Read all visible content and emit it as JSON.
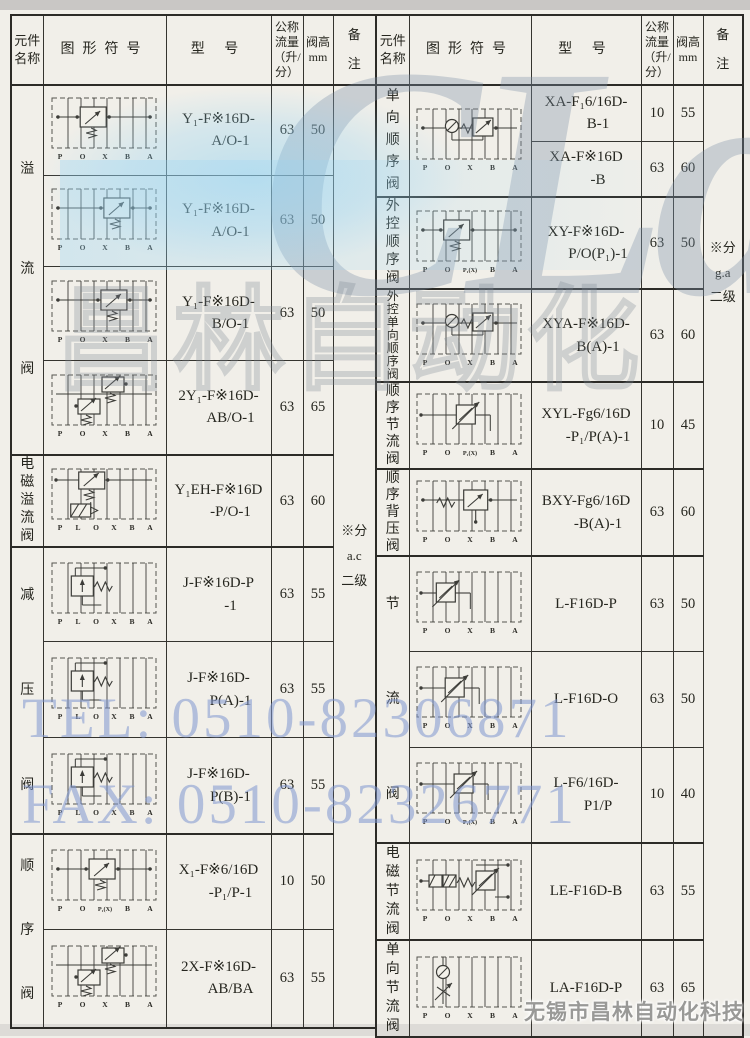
{
  "colors": {
    "paper": "#f1efe9",
    "border": "#35342f",
    "tint_blue": "#8cd0f2",
    "watermark_blue": "#7e96d0"
  },
  "watermarks": {
    "logo_text": "CLair",
    "logo_cn": "昌林自动化",
    "tel": "TEL: 0510-82306871",
    "fax": "FAX: 0510-82326771",
    "company": "无锡市昌林自动化科技"
  },
  "header": {
    "name": "元件名称",
    "symbol": "图形符号",
    "model": "型  号",
    "flow": "公称流量（升/分）",
    "height_line1": "阀高",
    "height_line2": "mm",
    "note_line1": "备",
    "note_line2": "注"
  },
  "left_table": {
    "note_lines": [
      "※分",
      "a.c",
      "二级"
    ],
    "groups": [
      {
        "name": "溢流阀",
        "rows": 4
      },
      {
        "name": "电磁溢流阀",
        "rows": 1
      },
      {
        "name": "减压阀",
        "rows": 3
      },
      {
        "name": "顺序阀",
        "rows": 2
      }
    ],
    "rows": [
      {
        "model": [
          "Y₁-F※16D-",
          "A/O-1"
        ],
        "flow": "63",
        "height": "50",
        "symbol": {
          "type": "relief",
          "vx": 0.3,
          "ports": [
            "P",
            "O",
            "X",
            "B",
            "A"
          ]
        }
      },
      {
        "model": [
          "Y₁-F※16D-",
          "A/O-1"
        ],
        "flow": "63",
        "height": "50",
        "symbol": {
          "type": "relief",
          "vx": 0.62,
          "ports": [
            "P",
            "O",
            "X",
            "B",
            "A"
          ]
        }
      },
      {
        "model": [
          "Y₁-F※16D-",
          "B/O-1"
        ],
        "flow": "63",
        "height": "50",
        "symbol": {
          "type": "relief",
          "vx": 0.58,
          "ports": [
            "P",
            "O",
            "X",
            "B",
            "A"
          ]
        }
      },
      {
        "model": [
          "2Y₁-F※16D-",
          "AB/O-1"
        ],
        "flow": "63",
        "height": "65",
        "symbol": {
          "type": "relief2",
          "vx": 0.5,
          "ports": [
            "P",
            "O",
            "X",
            "B",
            "A"
          ]
        }
      },
      {
        "model": [
          "Y₁EH-F※16D",
          "-P/O-1"
        ],
        "flow": "63",
        "height": "60",
        "symbol": {
          "type": "solenoid-relief",
          "vx": 0.28,
          "ports": [
            "P",
            "L",
            "O",
            "X",
            "B",
            "A"
          ]
        }
      },
      {
        "model": [
          "J-F※16D-P",
          "-1"
        ],
        "flow": "63",
        "height": "55",
        "symbol": {
          "type": "reduce",
          "vx": 0.18,
          "ports": [
            "P",
            "L",
            "O",
            "X",
            "B",
            "A"
          ]
        }
      },
      {
        "model": [
          "J-F※16D-",
          "P(A)-1"
        ],
        "flow": "63",
        "height": "55",
        "symbol": {
          "type": "reduce",
          "vx": 0.18,
          "ports": [
            "P",
            "L",
            "O",
            "X",
            "B",
            "A"
          ]
        }
      },
      {
        "model": [
          "J-F※16D-",
          "P(B)-1"
        ],
        "flow": "63",
        "height": "55",
        "symbol": {
          "type": "reduce",
          "vx": 0.18,
          "ports": [
            "P",
            "L",
            "O",
            "X",
            "B",
            "A"
          ]
        }
      },
      {
        "model": [
          "X₁-F※6/16D",
          "-P₁/P-1"
        ],
        "flow": "10",
        "height": "50",
        "symbol": {
          "type": "relief",
          "vx": 0.42,
          "ports": [
            "P",
            "O",
            "P₁(X)",
            "B",
            "A"
          ]
        }
      },
      {
        "model": [
          "2X-F※16D-",
          "AB/BA"
        ],
        "flow": "63",
        "height": "55",
        "symbol": {
          "type": "relief2",
          "vx": 0.58,
          "ports": [
            "P",
            "O",
            "X",
            "B",
            "A"
          ]
        }
      }
    ]
  },
  "right_table": {
    "note_lines": [
      "※分",
      "g.a",
      "二级"
    ],
    "groups": [
      {
        "name": "单向顺序阀",
        "rows": 2
      },
      {
        "name": "外控顺序阀",
        "rows": 1
      },
      {
        "name": "外控单向顺序阀",
        "rows": 1
      },
      {
        "name": "顺序节流阀",
        "rows": 1
      },
      {
        "name": "顺序背压阀",
        "rows": 1
      },
      {
        "name": "节流阀",
        "rows": 3
      },
      {
        "name": "电磁节流阀",
        "rows": 1
      },
      {
        "name": "单向节流阀",
        "rows": 1
      }
    ],
    "rows": [
      {
        "model": [
          "XA-F₁6/16D-",
          "B-1"
        ],
        "flow": "10",
        "height": "55",
        "symbol_rowspan": 2,
        "symbol": {
          "type": "check-relief",
          "vx": 0.58,
          "ports": [
            "P",
            "O",
            "X",
            "B",
            "A"
          ]
        }
      },
      {
        "model": [
          "XA-F※16D",
          "-B"
        ],
        "flow": "63",
        "height": "60",
        "symbol": "merge"
      },
      {
        "model": [
          "XY-F※16D-",
          "P/O(P₁)-1"
        ],
        "flow": "63",
        "height": "50",
        "symbol": {
          "type": "relief",
          "vx": 0.28,
          "ports": [
            "P",
            "O",
            "P₁(X)",
            "B",
            "A"
          ]
        }
      },
      {
        "model": [
          "XYA-F※16D-",
          "B(A)-1"
        ],
        "flow": "63",
        "height": "60",
        "symbol": {
          "type": "check-relief",
          "vx": 0.58,
          "ports": [
            "P",
            "O",
            "X",
            "B",
            "A"
          ]
        }
      },
      {
        "model": [
          "XYL-Fg6/16D",
          "-P₁/P(A)-1"
        ],
        "flow": "10",
        "height": "45",
        "symbol": {
          "type": "throttle",
          "vx": 0.45,
          "ports": [
            "P",
            "O",
            "P₁(X)",
            "B",
            "A"
          ]
        }
      },
      {
        "model": [
          "BXY-Fg6/16D",
          "-B(A)-1"
        ],
        "flow": "63",
        "height": "60",
        "symbol": {
          "type": "backpressure",
          "vx": 0.55,
          "ports": [
            "P",
            "O",
            "X",
            "B",
            "A"
          ]
        }
      },
      {
        "model": [
          "L-F16D-P"
        ],
        "flow": "63",
        "height": "50",
        "symbol": {
          "type": "throttle",
          "vx": 0.18,
          "ports": [
            "P",
            "O",
            "X",
            "B",
            "A"
          ]
        }
      },
      {
        "model": [
          "L-F16D-O"
        ],
        "flow": "63",
        "height": "50",
        "symbol": {
          "type": "throttle",
          "vx": 0.3,
          "ports": [
            "P",
            "O",
            "X",
            "B",
            "A"
          ]
        }
      },
      {
        "model": [
          "L-F6/16D-",
          "P1/P"
        ],
        "flow": "10",
        "height": "40",
        "symbol": {
          "type": "throttle",
          "vx": 0.42,
          "ports": [
            "P",
            "O",
            "P₁(X)",
            "B",
            "A"
          ]
        }
      },
      {
        "model": [
          "LE-F16D-B"
        ],
        "flow": "63",
        "height": "55",
        "symbol": {
          "type": "solenoid-throttle",
          "vx": 0.6,
          "ports": [
            "P",
            "O",
            "X",
            "B",
            "A"
          ]
        }
      },
      {
        "model": [
          "LA-F16D-P"
        ],
        "flow": "63",
        "height": "65",
        "symbol": {
          "type": "check-throttle",
          "vx": 0.2,
          "ports": [
            "P",
            "O",
            "X",
            "B",
            "A"
          ]
        }
      }
    ]
  }
}
